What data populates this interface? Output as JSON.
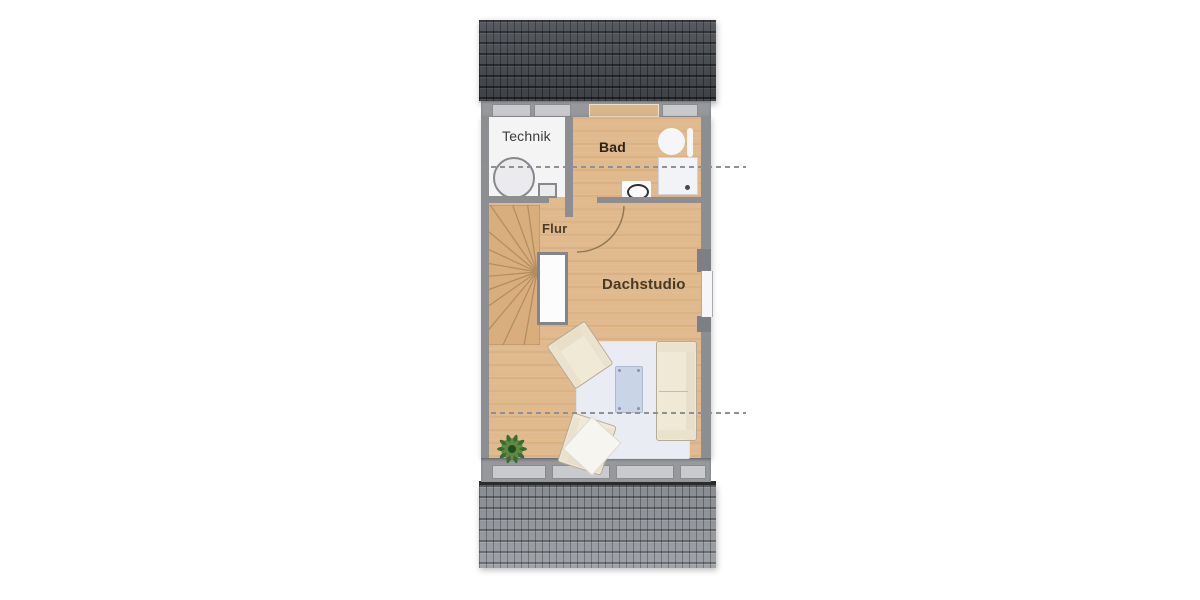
{
  "labels": {
    "technik": "Technik",
    "bad": "Bad",
    "flur": "Flur",
    "dachstudio": "Dachstudio"
  },
  "colors": {
    "wood": "#e0b98c",
    "technik_floor": "#f4f4f5",
    "wall": "#8d8e92",
    "wall_band": "#97989c",
    "window_inset": "#c9cace",
    "roof_dark": "#4b4f55",
    "roof_light": "#979ba1",
    "eave_dark": "#2c2d2f",
    "rug": "#e9ecf2",
    "upholstery": "#f0e9d6",
    "table_glass": "#c7d4e6",
    "plant_green": "#3f7233",
    "dash_line": "#8f9094",
    "fixture_white": "#f6f6f8"
  },
  "fixtures": [
    "winder-staircase",
    "storage-tank",
    "water-heater",
    "washbasin",
    "towel-rail",
    "shower",
    "toilet",
    "door-swing",
    "shaft",
    "rug",
    "coffee-table",
    "sofa",
    "armchair",
    "armchair",
    "throw-blanket",
    "potted-plant",
    "roof-window-band",
    "height-line",
    "height-line"
  ]
}
